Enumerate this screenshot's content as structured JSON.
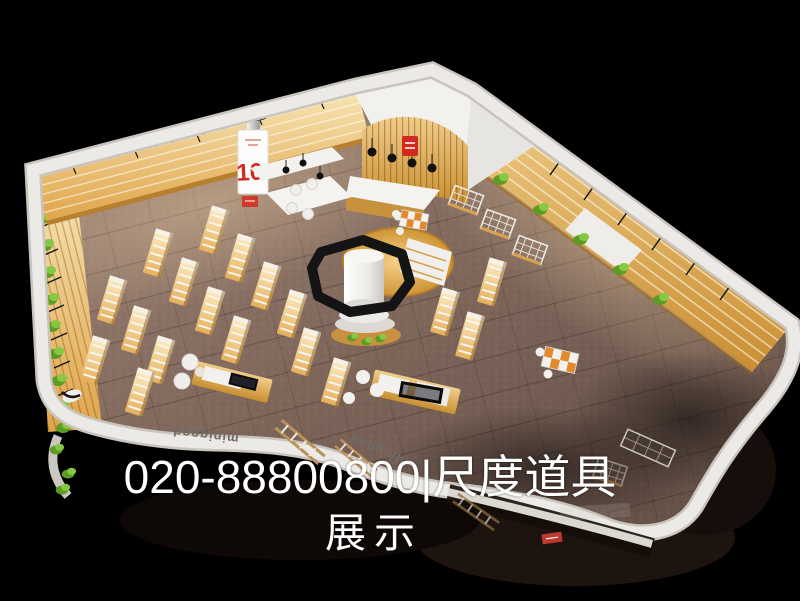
{
  "scene": {
    "caption": {
      "line1": "020-88800800|尺度道具",
      "line2": "展示"
    },
    "storefront_brand": "minigood",
    "promo_banner": {
      "value": "10."
    },
    "palette": {
      "background": "#000000",
      "carpet": "#8a7065",
      "wood": "#e0a64f",
      "plant_dark": "#5e9b24",
      "plant_light": "#85c943",
      "fascia_white": "#eceae6",
      "accent_red": "#d2281f",
      "caption_text": "#ffffff"
    }
  }
}
